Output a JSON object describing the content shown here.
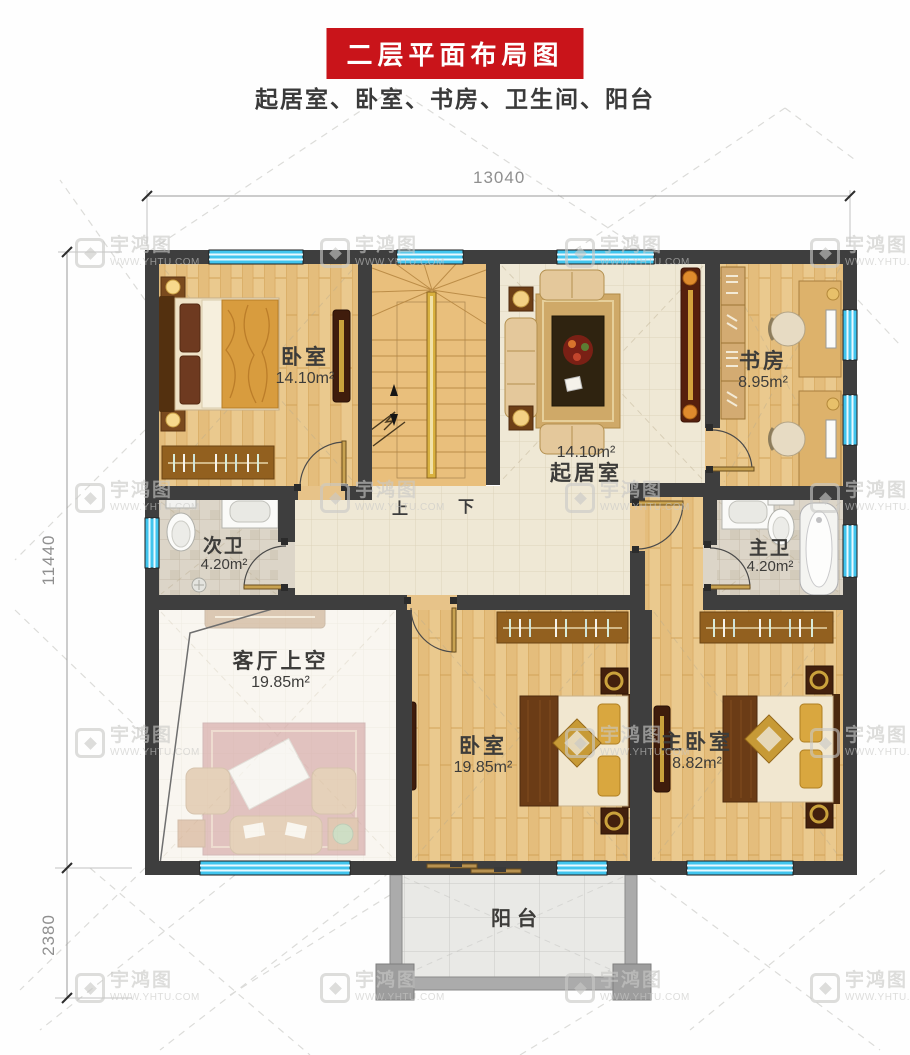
{
  "header": {
    "title": "二层平面布局图",
    "subtitle": "起居室、卧室、书房、卫生间、阳台"
  },
  "dimensions": {
    "width_top": "13040",
    "height_left": "11440",
    "balcony_left": "2380"
  },
  "rooms": {
    "bedroom_top_left": {
      "name": "卧室",
      "area": "14.10m²"
    },
    "study": {
      "name": "书房",
      "area": "8.95m²"
    },
    "living_room": {
      "name": "起居室",
      "area": "14.10m²"
    },
    "bath_second": {
      "name": "次卫",
      "area": "4.20m²"
    },
    "bath_master": {
      "name": "主卫",
      "area": "4.20m²"
    },
    "living_void": {
      "name": "客厅上空",
      "area": "19.85m²"
    },
    "bedroom_bottom": {
      "name": "卧室",
      "area": "19.85m²"
    },
    "bedroom_master": {
      "name": "主卧室",
      "area": "8.82m²"
    },
    "balcony": {
      "name": "阳台"
    }
  },
  "stairs": {
    "up_label": "上",
    "down_label": "下"
  },
  "watermark": {
    "brand": "宇鸿图",
    "url": "WWW.YHTU.COM"
  },
  "colors": {
    "banner_red": "#c9141a",
    "wall_dark": "#3e3e3e",
    "window_cyan": "#41c5ee",
    "wood_floor": "#eac98e",
    "tile_floor": "#efe8d5",
    "bath_tile": "#dcd5c8",
    "balcony_tile": "#e9e9e6",
    "dim_text": "#8f8f8f",
    "watermark_gray": "#c9c9c7"
  }
}
